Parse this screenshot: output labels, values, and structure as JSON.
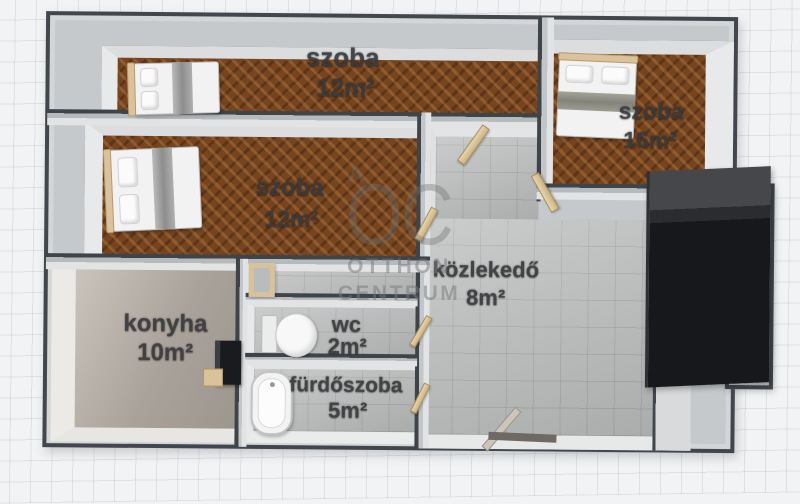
{
  "watermark": {
    "logo": "OC",
    "roof_mark": "^",
    "line1": "OTTHON",
    "line2": "CENTRUM"
  },
  "rooms": [
    {
      "id": "szoba-top",
      "name": "szoba",
      "area": "12m²",
      "floor": "parquet",
      "furniture": [
        "bed"
      ]
    },
    {
      "id": "szoba-right",
      "name": "szoba",
      "area": "16m²",
      "floor": "parquet",
      "furniture": [
        "bed"
      ]
    },
    {
      "id": "szoba-middle",
      "name": "szoba",
      "area": "12m²",
      "floor": "parquet",
      "furniture": [
        "bed"
      ]
    },
    {
      "id": "kozlekedo",
      "name": "közlekedő",
      "area": "8m²",
      "floor": "tile",
      "furniture": [
        "wardrobe",
        "entrance-door"
      ]
    },
    {
      "id": "konyha",
      "name": "konyha",
      "area": "10m²",
      "floor": "stone",
      "furniture": [
        "stove",
        "counter"
      ]
    },
    {
      "id": "wc",
      "name": "wc",
      "area": "2m²",
      "floor": "tile",
      "furniture": [
        "toilet"
      ]
    },
    {
      "id": "furdoszoba",
      "name": "fürdőszoba",
      "area": "5m²",
      "floor": "tile",
      "furniture": [
        "bathtub"
      ]
    }
  ],
  "colors": {
    "parquet": "#76451f",
    "wall_top": "#c6c9cb",
    "wall_edge": "#42474d",
    "tile_floor": "#b4b6b6",
    "kitchen_floor": "#a8a199",
    "wardrobe": "#141518",
    "wood_accent": "#d9c29c",
    "label_text": "#3a3a3c",
    "background": "#f2f3f4"
  }
}
